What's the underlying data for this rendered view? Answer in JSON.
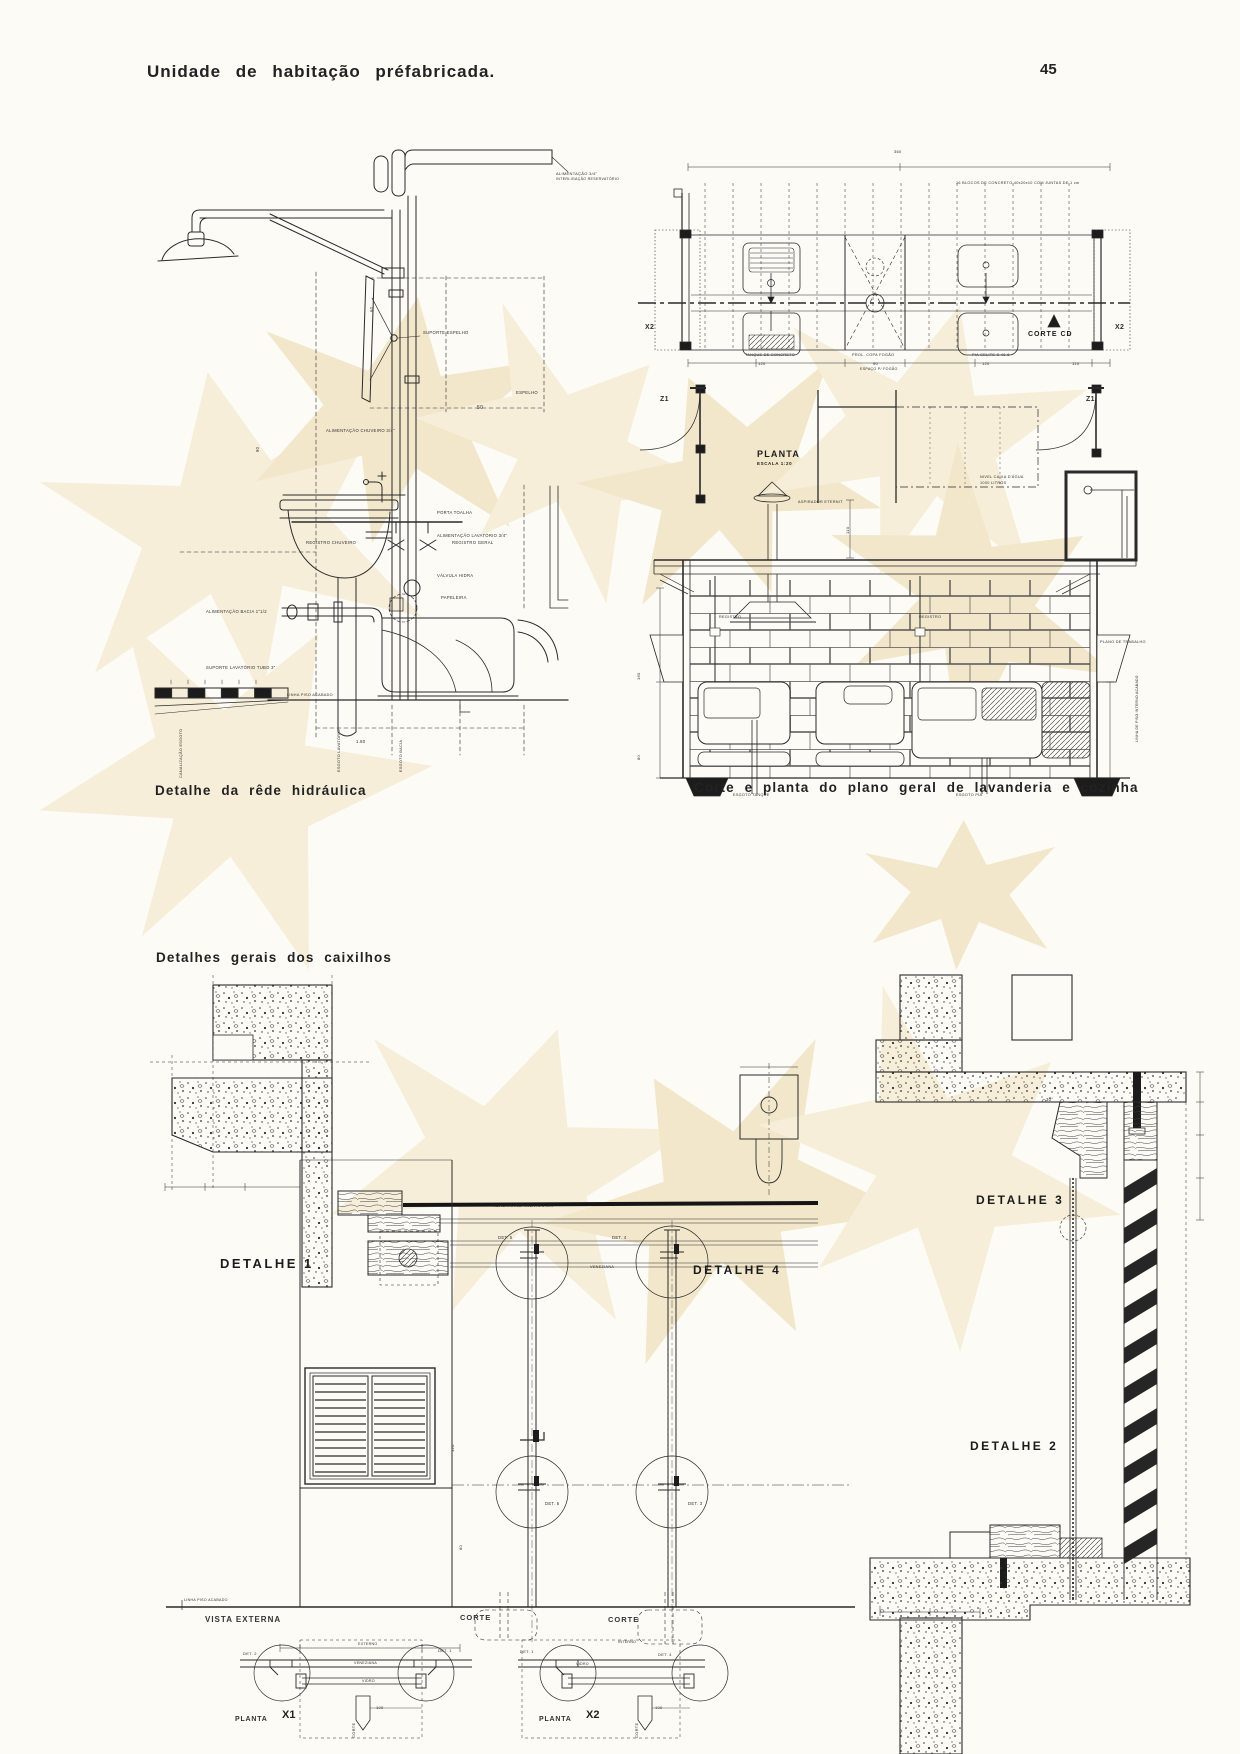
{
  "header": {
    "title": "Unidade de habitação préfabricada.",
    "page_number": "45"
  },
  "captions": {
    "hydraulic": "Detalhe da rêde hidráulica",
    "laundry": "Corte e planta do plano geral de lavanderia e cozinha",
    "caixilhos": "Detalhes gerais dos caixilhos"
  },
  "plan": {
    "title": "PLANTA",
    "scale": "ESCALA 1:20",
    "corte_cd": "CORTE CD"
  },
  "details": {
    "d1": "DETALHE 1",
    "d2": "DETALHE 2",
    "d3": "DETALHE 3",
    "d4": "DETALHE 4"
  },
  "bottom": {
    "vista_externa": "VISTA EXTERNA",
    "corte_left": "CORTE",
    "corte_right": "CORTE",
    "x1_word": "PLANTA",
    "x1_num": "X1",
    "x2_word": "PLANTA",
    "x2_num": "X2"
  },
  "colors": {
    "paper": "#fcfbf6",
    "ink": "#222222",
    "watermark": "#f6eed9"
  },
  "annotations": [
    {
      "t": "ALIMENTAÇÃO 3/4\"",
      "x": 556,
      "y": 172,
      "s": 4
    },
    {
      "t": "INTERLIGAÇÃO RESERVATÓRIO",
      "x": 556,
      "y": 178,
      "s": 3.6
    },
    {
      "t": "ALIMENTAÇÃO CHUVEIRO 3/4\"",
      "x": 326,
      "y": 429,
      "s": 4.2
    },
    {
      "t": "REGISTRO CHUVEIRO",
      "x": 306,
      "y": 541,
      "s": 4.2
    },
    {
      "t": "REGISTRO GERAL",
      "x": 452,
      "y": 541,
      "s": 4.2
    },
    {
      "t": "SUPORTE ESPELHO",
      "x": 423,
      "y": 331,
      "s": 4.2
    },
    {
      "t": "ESPELHO",
      "x": 516,
      "y": 391,
      "s": 4.2
    },
    {
      "t": "50",
      "x": 477,
      "y": 406,
      "s": 5
    },
    {
      "t": "PORTA TOALHA",
      "x": 437,
      "y": 511,
      "s": 4.2
    },
    {
      "t": "ALIMENTAÇÃO LAVATÓRIO 3/4\"",
      "x": 437,
      "y": 534,
      "s": 4.2
    },
    {
      "t": "VÁLVULA HIDRA",
      "x": 437,
      "y": 574,
      "s": 4.2
    },
    {
      "t": "PAPELEIRA",
      "x": 441,
      "y": 596,
      "s": 4.2
    },
    {
      "t": "ALIMENTAÇÃO BACIA 1\"1/2",
      "x": 206,
      "y": 610,
      "s": 4.2
    },
    {
      "t": "SUPORTE LAVATÓRIO TUBO 3\"",
      "x": 206,
      "y": 666,
      "s": 4.2
    },
    {
      "t": "LINHA PISO ACABADO",
      "x": 287,
      "y": 694,
      "s": 3.8
    },
    {
      "t": "1.80",
      "x": 356,
      "y": 740,
      "s": 4.2
    },
    {
      "t": "ESGOTO LAVATÓRIO",
      "x": 338,
      "y": 772,
      "s": 3.8,
      "r": -90
    },
    {
      "t": "ESGOTO BACIA",
      "x": 400,
      "y": 772,
      "s": 3.8,
      "r": -90
    },
    {
      "t": "CANALIZAÇÃO ESGOTO",
      "x": 180,
      "y": 778,
      "s": 3.8,
      "r": -90
    },
    {
      "t": "90",
      "x": 256,
      "y": 452,
      "s": 4.2,
      "r": -90
    },
    {
      "t": "60",
      "x": 370,
      "y": 312,
      "s": 4.2,
      "r": -90
    },
    {
      "t": "16 BLOCOS DE CONCRETO 40x20x10 COM JUNTAS DE 1 cm",
      "x": 956,
      "y": 182,
      "s": 3.8
    },
    {
      "t": "360",
      "x": 894,
      "y": 150,
      "s": 4
    },
    {
      "t": "TANQUE DE CONCRETO",
      "x": 745,
      "y": 354,
      "s": 3.8
    },
    {
      "t": "PROL. COPA FOGÃO",
      "x": 852,
      "y": 354,
      "s": 3.8
    },
    {
      "t": "PIA CELITE S 40-6",
      "x": 972,
      "y": 354,
      "s": 3.8
    },
    {
      "t": "120",
      "x": 758,
      "y": 362,
      "s": 4
    },
    {
      "t": "90",
      "x": 873,
      "y": 362,
      "s": 4
    },
    {
      "t": "ESPAÇO P/ FOGÃO",
      "x": 860,
      "y": 368,
      "s": 3.6
    },
    {
      "t": "120",
      "x": 982,
      "y": 362,
      "s": 4
    },
    {
      "t": "110",
      "x": 1072,
      "y": 362,
      "s": 4
    },
    {
      "t": "X2",
      "x": 645,
      "y": 324,
      "s": 7,
      "w": 700
    },
    {
      "t": "X2",
      "x": 1115,
      "y": 324,
      "s": 7,
      "w": 700
    },
    {
      "t": "Z1",
      "x": 660,
      "y": 396,
      "s": 7,
      "w": 700
    },
    {
      "t": "Z1",
      "x": 1086,
      "y": 396,
      "s": 7,
      "w": 700
    },
    {
      "t": "NIVEL CAIXA D'ÁGUA",
      "x": 980,
      "y": 476,
      "s": 3.8
    },
    {
      "t": "1000 LITROS",
      "x": 980,
      "y": 482,
      "s": 3.8
    },
    {
      "t": "ASPIRADOR ETERNIT",
      "x": 798,
      "y": 501,
      "s": 3.8
    },
    {
      "t": "110",
      "x": 846,
      "y": 534,
      "s": 4,
      "r": -90
    },
    {
      "t": "REGISTRO",
      "x": 719,
      "y": 616,
      "s": 3.8
    },
    {
      "t": "REGISTRO",
      "x": 919,
      "y": 616,
      "s": 3.8
    },
    {
      "t": "PLANO DE TRABALHO",
      "x": 1100,
      "y": 641,
      "s": 3.8
    },
    {
      "t": "LINHA DE PISO INTERNO ACABADO",
      "x": 1136,
      "y": 742,
      "s": 3.4,
      "r": -90
    },
    {
      "t": "ESGOTO TANQUE",
      "x": 733,
      "y": 794,
      "s": 3.8
    },
    {
      "t": "ESGOTO PIA",
      "x": 956,
      "y": 794,
      "s": 3.8
    },
    {
      "t": "160",
      "x": 637,
      "y": 680,
      "s": 4,
      "r": -90
    },
    {
      "t": "80",
      "x": 637,
      "y": 760,
      "s": 4,
      "r": -90
    },
    {
      "t": "VIDRO TRANSPARENTE 3 mm",
      "x": 492,
      "y": 1205,
      "s": 3.8
    },
    {
      "t": "VENEZIANA",
      "x": 590,
      "y": 1266,
      "s": 3.8
    },
    {
      "t": "30°",
      "x": 1046,
      "y": 1098,
      "s": 4.2
    },
    {
      "t": "DET. 5",
      "x": 498,
      "y": 1236,
      "s": 4.2
    },
    {
      "t": "DET. 4",
      "x": 612,
      "y": 1236,
      "s": 4.2
    },
    {
      "t": "DET. 5",
      "x": 545,
      "y": 1502,
      "s": 4.2
    },
    {
      "t": "DET. 3",
      "x": 688,
      "y": 1502,
      "s": 4.2
    },
    {
      "t": "120",
      "x": 451,
      "y": 1452,
      "s": 4,
      "r": -90
    },
    {
      "t": "80",
      "x": 459,
      "y": 1550,
      "s": 4,
      "r": -90
    },
    {
      "t": "LINHA PISO ACABADO",
      "x": 184,
      "y": 1599,
      "s": 3.6
    },
    {
      "t": "DET. 2",
      "x": 243,
      "y": 1652,
      "s": 4
    },
    {
      "t": "DET. 1",
      "x": 438,
      "y": 1649,
      "s": 4
    },
    {
      "t": "EXTERNO",
      "x": 358,
      "y": 1643,
      "s": 3.6
    },
    {
      "t": "VENEZIANA",
      "x": 354,
      "y": 1662,
      "s": 3.6
    },
    {
      "t": "VIDRO",
      "x": 362,
      "y": 1680,
      "s": 3.6
    },
    {
      "t": "CORTE",
      "x": 352,
      "y": 1738,
      "s": 4,
      "r": -90
    },
    {
      "t": "100",
      "x": 376,
      "y": 1706,
      "s": 4
    },
    {
      "t": "DET. 1",
      "x": 520,
      "y": 1650,
      "s": 4
    },
    {
      "t": "DET. 4",
      "x": 658,
      "y": 1653,
      "s": 4
    },
    {
      "t": "INTERNO",
      "x": 618,
      "y": 1641,
      "s": 3.6
    },
    {
      "t": "VIDRO",
      "x": 576,
      "y": 1663,
      "s": 3.6
    },
    {
      "t": "CORTE",
      "x": 635,
      "y": 1738,
      "s": 4,
      "r": -90
    },
    {
      "t": "100",
      "x": 655,
      "y": 1706,
      "s": 4
    }
  ]
}
